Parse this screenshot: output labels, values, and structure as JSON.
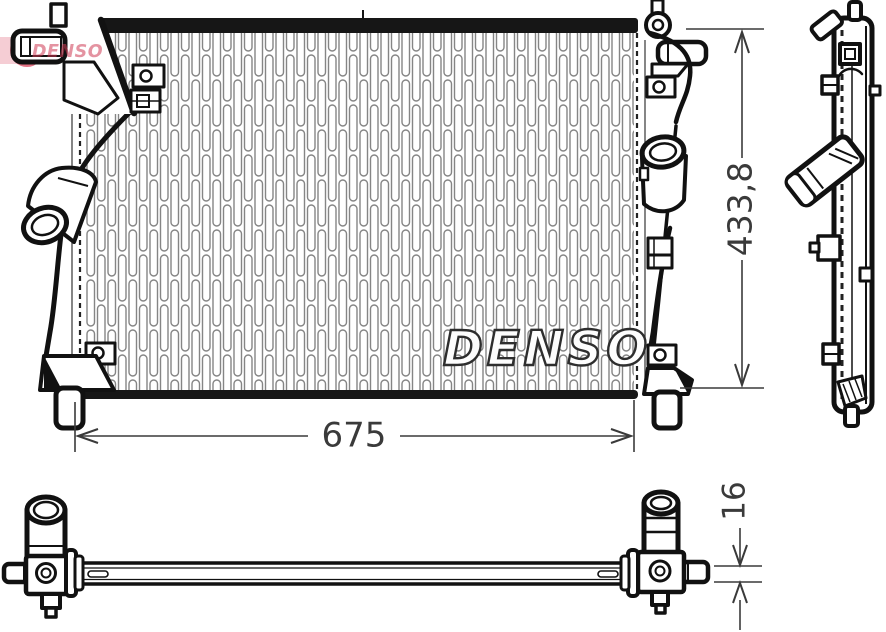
{
  "brand": {
    "logo_text": "DENSO",
    "core_watermark": "DENSO",
    "logo_red": "#cf3b55",
    "logo_crescent_red": "#dc5066",
    "logo_band_pink": "rgba(224,104,124,0.33)"
  },
  "dimensions": {
    "width_label": "675",
    "height_label": "433,8",
    "thickness_label": "16"
  }
}
